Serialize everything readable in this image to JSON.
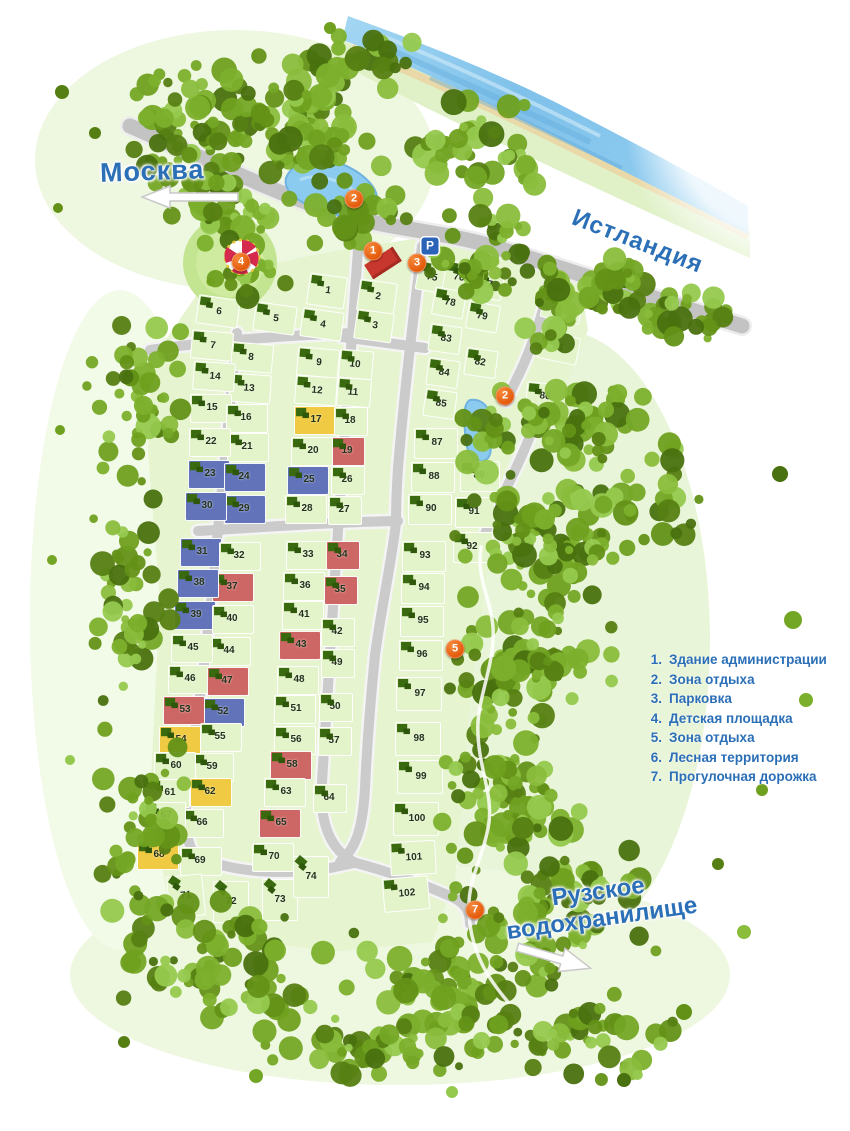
{
  "map": {
    "labels": {
      "moscow": "Москва",
      "istlandia": "Истландия",
      "reservoir_line1": "Рузское",
      "reservoir_line2": "водохранилище",
      "parking": "P"
    },
    "legend": {
      "items": [
        {
          "num": "1.",
          "label": "Здание администрации"
        },
        {
          "num": "2.",
          "label": "Зона отдыха"
        },
        {
          "num": "3.",
          "label": "Парковка"
        },
        {
          "num": "4.",
          "label": "Детская площадка"
        },
        {
          "num": "5.",
          "label": "Зона отдыха"
        },
        {
          "num": "6.",
          "label": "Лесная территория"
        },
        {
          "num": "7.",
          "label": "Прогулочная дорожка"
        }
      ]
    },
    "markers": [
      {
        "n": "1",
        "x": 373,
        "y": 251
      },
      {
        "n": "2",
        "x": 354,
        "y": 199
      },
      {
        "n": "3",
        "x": 417,
        "y": 263
      },
      {
        "n": "4",
        "x": 241,
        "y": 262
      },
      {
        "n": "2",
        "x": 505,
        "y": 396
      },
      {
        "n": "5",
        "x": 455,
        "y": 649
      },
      {
        "n": "7",
        "x": 475,
        "y": 910
      }
    ],
    "colors": {
      "plot_green": "#e3f3ca",
      "plot_yellow": "#f0ca43",
      "plot_blue": "#6273b9",
      "plot_red": "#cd6765",
      "house_green": "#3a6a10",
      "house_shade": "#2f570c",
      "road_grey": "#c9c9c9",
      "text_blue": "#2b6fb7",
      "marker_orange": "#e8611c",
      "water_blue": "#85c7ec"
    },
    "plots": [
      {
        "n": "1",
        "x": 327,
        "y": 291,
        "r": 8,
        "w": 38,
        "h": 32
      },
      {
        "n": "2",
        "x": 377,
        "y": 297,
        "r": 8,
        "w": 38,
        "h": 32
      },
      {
        "n": "3",
        "x": 374,
        "y": 326,
        "r": 8,
        "w": 38,
        "h": 30
      },
      {
        "n": "4",
        "x": 322,
        "y": 324,
        "r": 8
      },
      {
        "n": "5",
        "x": 275,
        "y": 318,
        "r": 8
      },
      {
        "n": "6",
        "x": 218,
        "y": 311,
        "r": 8
      },
      {
        "n": "7",
        "x": 212,
        "y": 345,
        "r": 5
      },
      {
        "n": "8",
        "x": 252,
        "y": 357,
        "f": 1,
        "r": 5
      },
      {
        "n": "9",
        "x": 318,
        "y": 362,
        "r": 5
      },
      {
        "n": "10",
        "x": 356,
        "y": 364,
        "f": 1,
        "r": 5,
        "w": 34
      },
      {
        "n": "11",
        "x": 354,
        "y": 392,
        "f": 1,
        "r": 4,
        "w": 34
      },
      {
        "n": "12",
        "x": 316,
        "y": 390,
        "r": 4
      },
      {
        "n": "13",
        "x": 250,
        "y": 388,
        "f": 1,
        "r": 4
      },
      {
        "n": "14",
        "x": 214,
        "y": 376,
        "r": 4
      },
      {
        "n": "15",
        "x": 211,
        "y": 408
      },
      {
        "n": "16",
        "x": 247,
        "y": 418,
        "f": 1
      },
      {
        "n": "17",
        "x": 315,
        "y": 420,
        "c": "y"
      },
      {
        "n": "18",
        "x": 351,
        "y": 421,
        "f": 1,
        "w": 34
      },
      {
        "n": "19",
        "x": 348,
        "y": 451,
        "f": 1,
        "c": "r",
        "w": 34
      },
      {
        "n": "20",
        "x": 312,
        "y": 451
      },
      {
        "n": "21",
        "x": 248,
        "y": 447,
        "f": 1
      },
      {
        "n": "22",
        "x": 210,
        "y": 442
      },
      {
        "n": "23",
        "x": 209,
        "y": 474,
        "c": "b"
      },
      {
        "n": "24",
        "x": 245,
        "y": 477,
        "f": 1,
        "c": "b"
      },
      {
        "n": "25",
        "x": 308,
        "y": 480,
        "c": "b"
      },
      {
        "n": "26",
        "x": 348,
        "y": 480,
        "f": 1,
        "w": 34
      },
      {
        "n": "27",
        "x": 345,
        "y": 510,
        "f": 1,
        "w": 34
      },
      {
        "n": "28",
        "x": 306,
        "y": 509
      },
      {
        "n": "29",
        "x": 245,
        "y": 509,
        "f": 1,
        "c": "b"
      },
      {
        "n": "30",
        "x": 206,
        "y": 506,
        "c": "b"
      },
      {
        "n": "31",
        "x": 201,
        "y": 552,
        "c": "b"
      },
      {
        "n": "32",
        "x": 240,
        "y": 556,
        "f": 1
      },
      {
        "n": "33",
        "x": 307,
        "y": 555
      },
      {
        "n": "34",
        "x": 343,
        "y": 555,
        "f": 1,
        "c": "r",
        "w": 34
      },
      {
        "n": "35",
        "x": 341,
        "y": 590,
        "f": 1,
        "c": "r",
        "w": 34
      },
      {
        "n": "36",
        "x": 304,
        "y": 586
      },
      {
        "n": "37",
        "x": 233,
        "y": 587,
        "f": 1,
        "c": "r"
      },
      {
        "n": "38",
        "x": 198,
        "y": 583,
        "c": "b"
      },
      {
        "n": "39",
        "x": 195,
        "y": 615,
        "c": "b"
      },
      {
        "n": "40",
        "x": 233,
        "y": 619,
        "f": 1
      },
      {
        "n": "41",
        "x": 303,
        "y": 615
      },
      {
        "n": "42",
        "x": 338,
        "y": 632,
        "f": 1,
        "w": 34
      },
      {
        "n": "43",
        "x": 300,
        "y": 645,
        "c": "r"
      },
      {
        "n": "44",
        "x": 230,
        "y": 651,
        "f": 1
      },
      {
        "n": "45",
        "x": 192,
        "y": 648
      },
      {
        "n": "46",
        "x": 189,
        "y": 679
      },
      {
        "n": "47",
        "x": 228,
        "y": 681,
        "f": 1,
        "c": "r"
      },
      {
        "n": "48",
        "x": 298,
        "y": 680
      },
      {
        "n": "49",
        "x": 338,
        "y": 663,
        "f": 1,
        "w": 34
      },
      {
        "n": "50",
        "x": 336,
        "y": 707,
        "f": 1,
        "w": 34
      },
      {
        "n": "51",
        "x": 295,
        "y": 709
      },
      {
        "n": "52",
        "x": 224,
        "y": 712,
        "f": 1,
        "c": "b"
      },
      {
        "n": "53",
        "x": 184,
        "y": 710,
        "c": "r"
      },
      {
        "n": "54",
        "x": 180,
        "y": 740,
        "c": "y"
      },
      {
        "n": "55",
        "x": 221,
        "y": 737,
        "f": 1
      },
      {
        "n": "56",
        "x": 295,
        "y": 740
      },
      {
        "n": "57",
        "x": 335,
        "y": 741,
        "f": 1,
        "w": 34
      },
      {
        "n": "58",
        "x": 291,
        "y": 765,
        "c": "r"
      },
      {
        "n": "59",
        "x": 213,
        "y": 767,
        "f": 1
      },
      {
        "n": "60",
        "x": 175,
        "y": 766
      },
      {
        "n": "61",
        "x": 169,
        "y": 793
      },
      {
        "n": "62",
        "x": 211,
        "y": 792,
        "f": 1,
        "c": "y"
      },
      {
        "n": "63",
        "x": 285,
        "y": 792
      },
      {
        "n": "64",
        "x": 330,
        "y": 798,
        "f": 1,
        "w": 34
      },
      {
        "n": "65",
        "x": 280,
        "y": 823,
        "c": "r"
      },
      {
        "n": "66",
        "x": 203,
        "y": 823,
        "f": 1
      },
      {
        "n": "67",
        "x": 165,
        "y": 816
      },
      {
        "n": "68",
        "x": 158,
        "y": 855,
        "c": "y"
      },
      {
        "n": "69",
        "x": 201,
        "y": 861,
        "f": 1
      },
      {
        "n": "70",
        "x": 273,
        "y": 857
      },
      {
        "n": "71",
        "x": 186,
        "y": 896,
        "f": 3,
        "r": -6,
        "w": 36,
        "h": 42
      },
      {
        "n": "72",
        "x": 231,
        "y": 902,
        "f": 3,
        "w": 36,
        "h": 42
      },
      {
        "n": "73",
        "x": 280,
        "y": 900,
        "f": 3,
        "w": 36,
        "h": 42
      },
      {
        "n": "74",
        "x": 311,
        "y": 877,
        "f": 3,
        "w": 36,
        "h": 42
      },
      {
        "n": "75",
        "x": 432,
        "y": 277,
        "f": 2,
        "r": 10,
        "w": 30,
        "h": 30
      },
      {
        "n": "76",
        "x": 459,
        "y": 277,
        "f": 2,
        "r": 10,
        "w": 30,
        "h": 30
      },
      {
        "n": "77",
        "x": 488,
        "y": 285,
        "f": 1,
        "r": 10,
        "w": 30,
        "h": 28
      },
      {
        "n": "78",
        "x": 449,
        "y": 303,
        "r": 10,
        "w": 32,
        "h": 28
      },
      {
        "n": "79",
        "x": 483,
        "y": 317,
        "f": 1,
        "r": 10,
        "w": 32,
        "h": 28
      },
      {
        "n": "80",
        "x": 562,
        "y": 307,
        "f": 1,
        "r": 12,
        "w": 40,
        "h": 28
      },
      {
        "n": "81",
        "x": 559,
        "y": 348,
        "f": 1,
        "r": 12,
        "w": 40,
        "h": 28
      },
      {
        "n": "82",
        "x": 481,
        "y": 363,
        "f": 1,
        "r": 8,
        "w": 32,
        "h": 28
      },
      {
        "n": "83",
        "x": 445,
        "y": 339,
        "r": 8,
        "w": 32,
        "h": 28
      },
      {
        "n": "84",
        "x": 443,
        "y": 373,
        "r": 8,
        "w": 32,
        "h": 28
      },
      {
        "n": "85",
        "x": 440,
        "y": 404,
        "r": 8,
        "w": 32,
        "h": 28
      },
      {
        "n": "86",
        "x": 546,
        "y": 397,
        "f": 1,
        "r": 6,
        "w": 40,
        "h": 28
      },
      {
        "n": "87",
        "x": 436,
        "y": 443,
        "w": 44,
        "h": 31
      },
      {
        "n": "88",
        "x": 433,
        "y": 477,
        "w": 44,
        "h": 31
      },
      {
        "n": "89",
        "x": 480,
        "y": 476,
        "f": 1,
        "w": 40,
        "h": 31
      },
      {
        "n": "90",
        "x": 430,
        "y": 509,
        "w": 44,
        "h": 31
      },
      {
        "n": "91",
        "x": 475,
        "y": 512,
        "f": 1,
        "w": 40,
        "h": 31
      },
      {
        "n": "92",
        "x": 473,
        "y": 547,
        "f": 1,
        "w": 40,
        "h": 31
      },
      {
        "n": "93",
        "x": 424,
        "y": 556,
        "w": 44,
        "h": 31
      },
      {
        "n": "94",
        "x": 423,
        "y": 588,
        "w": 44,
        "h": 31
      },
      {
        "n": "95",
        "x": 422,
        "y": 621,
        "w": 44,
        "h": 31
      },
      {
        "n": "96",
        "x": 421,
        "y": 655,
        "w": 44,
        "h": 31
      },
      {
        "n": "97",
        "x": 419,
        "y": 694,
        "w": 46,
        "h": 34
      },
      {
        "n": "98",
        "x": 418,
        "y": 739,
        "w": 46,
        "h": 34
      },
      {
        "n": "99",
        "x": 420,
        "y": 777,
        "w": 46,
        "h": 34
      },
      {
        "n": "100",
        "x": 416,
        "y": 819,
        "w": 46,
        "h": 34
      },
      {
        "n": "101",
        "x": 413,
        "y": 858,
        "r": -3,
        "w": 46,
        "h": 34
      },
      {
        "n": "102",
        "x": 406,
        "y": 894,
        "r": -5,
        "w": 46,
        "h": 34
      }
    ]
  }
}
